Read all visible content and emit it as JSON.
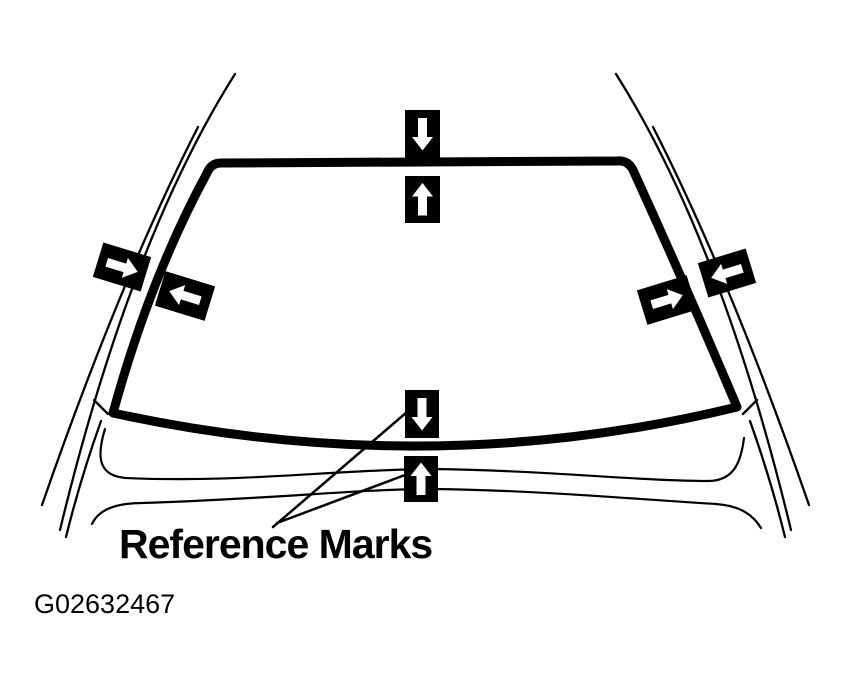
{
  "figure": {
    "label": "Reference Marks",
    "figure_id": "G02632467",
    "colors": {
      "ink": "#000000",
      "paper": "#ffffff"
    },
    "marks": [
      {
        "name": "top-body-mark",
        "icon": "arrow-down-icon",
        "glyph": "↓"
      },
      {
        "name": "top-glass-mark",
        "icon": "arrow-up-icon",
        "glyph": "↑"
      },
      {
        "name": "left-body-mark",
        "icon": "arrow-right-icon",
        "glyph": "→"
      },
      {
        "name": "left-glass-mark",
        "icon": "arrow-left-icon",
        "glyph": "←"
      },
      {
        "name": "right-glass-mark",
        "icon": "arrow-right-icon",
        "glyph": "→"
      },
      {
        "name": "right-body-mark",
        "icon": "arrow-left-icon",
        "glyph": "←"
      },
      {
        "name": "bottom-glass-mark",
        "icon": "arrow-down-icon",
        "glyph": "↓"
      },
      {
        "name": "bottom-cowl-mark",
        "icon": "arrow-up-icon",
        "glyph": "↑"
      }
    ]
  }
}
